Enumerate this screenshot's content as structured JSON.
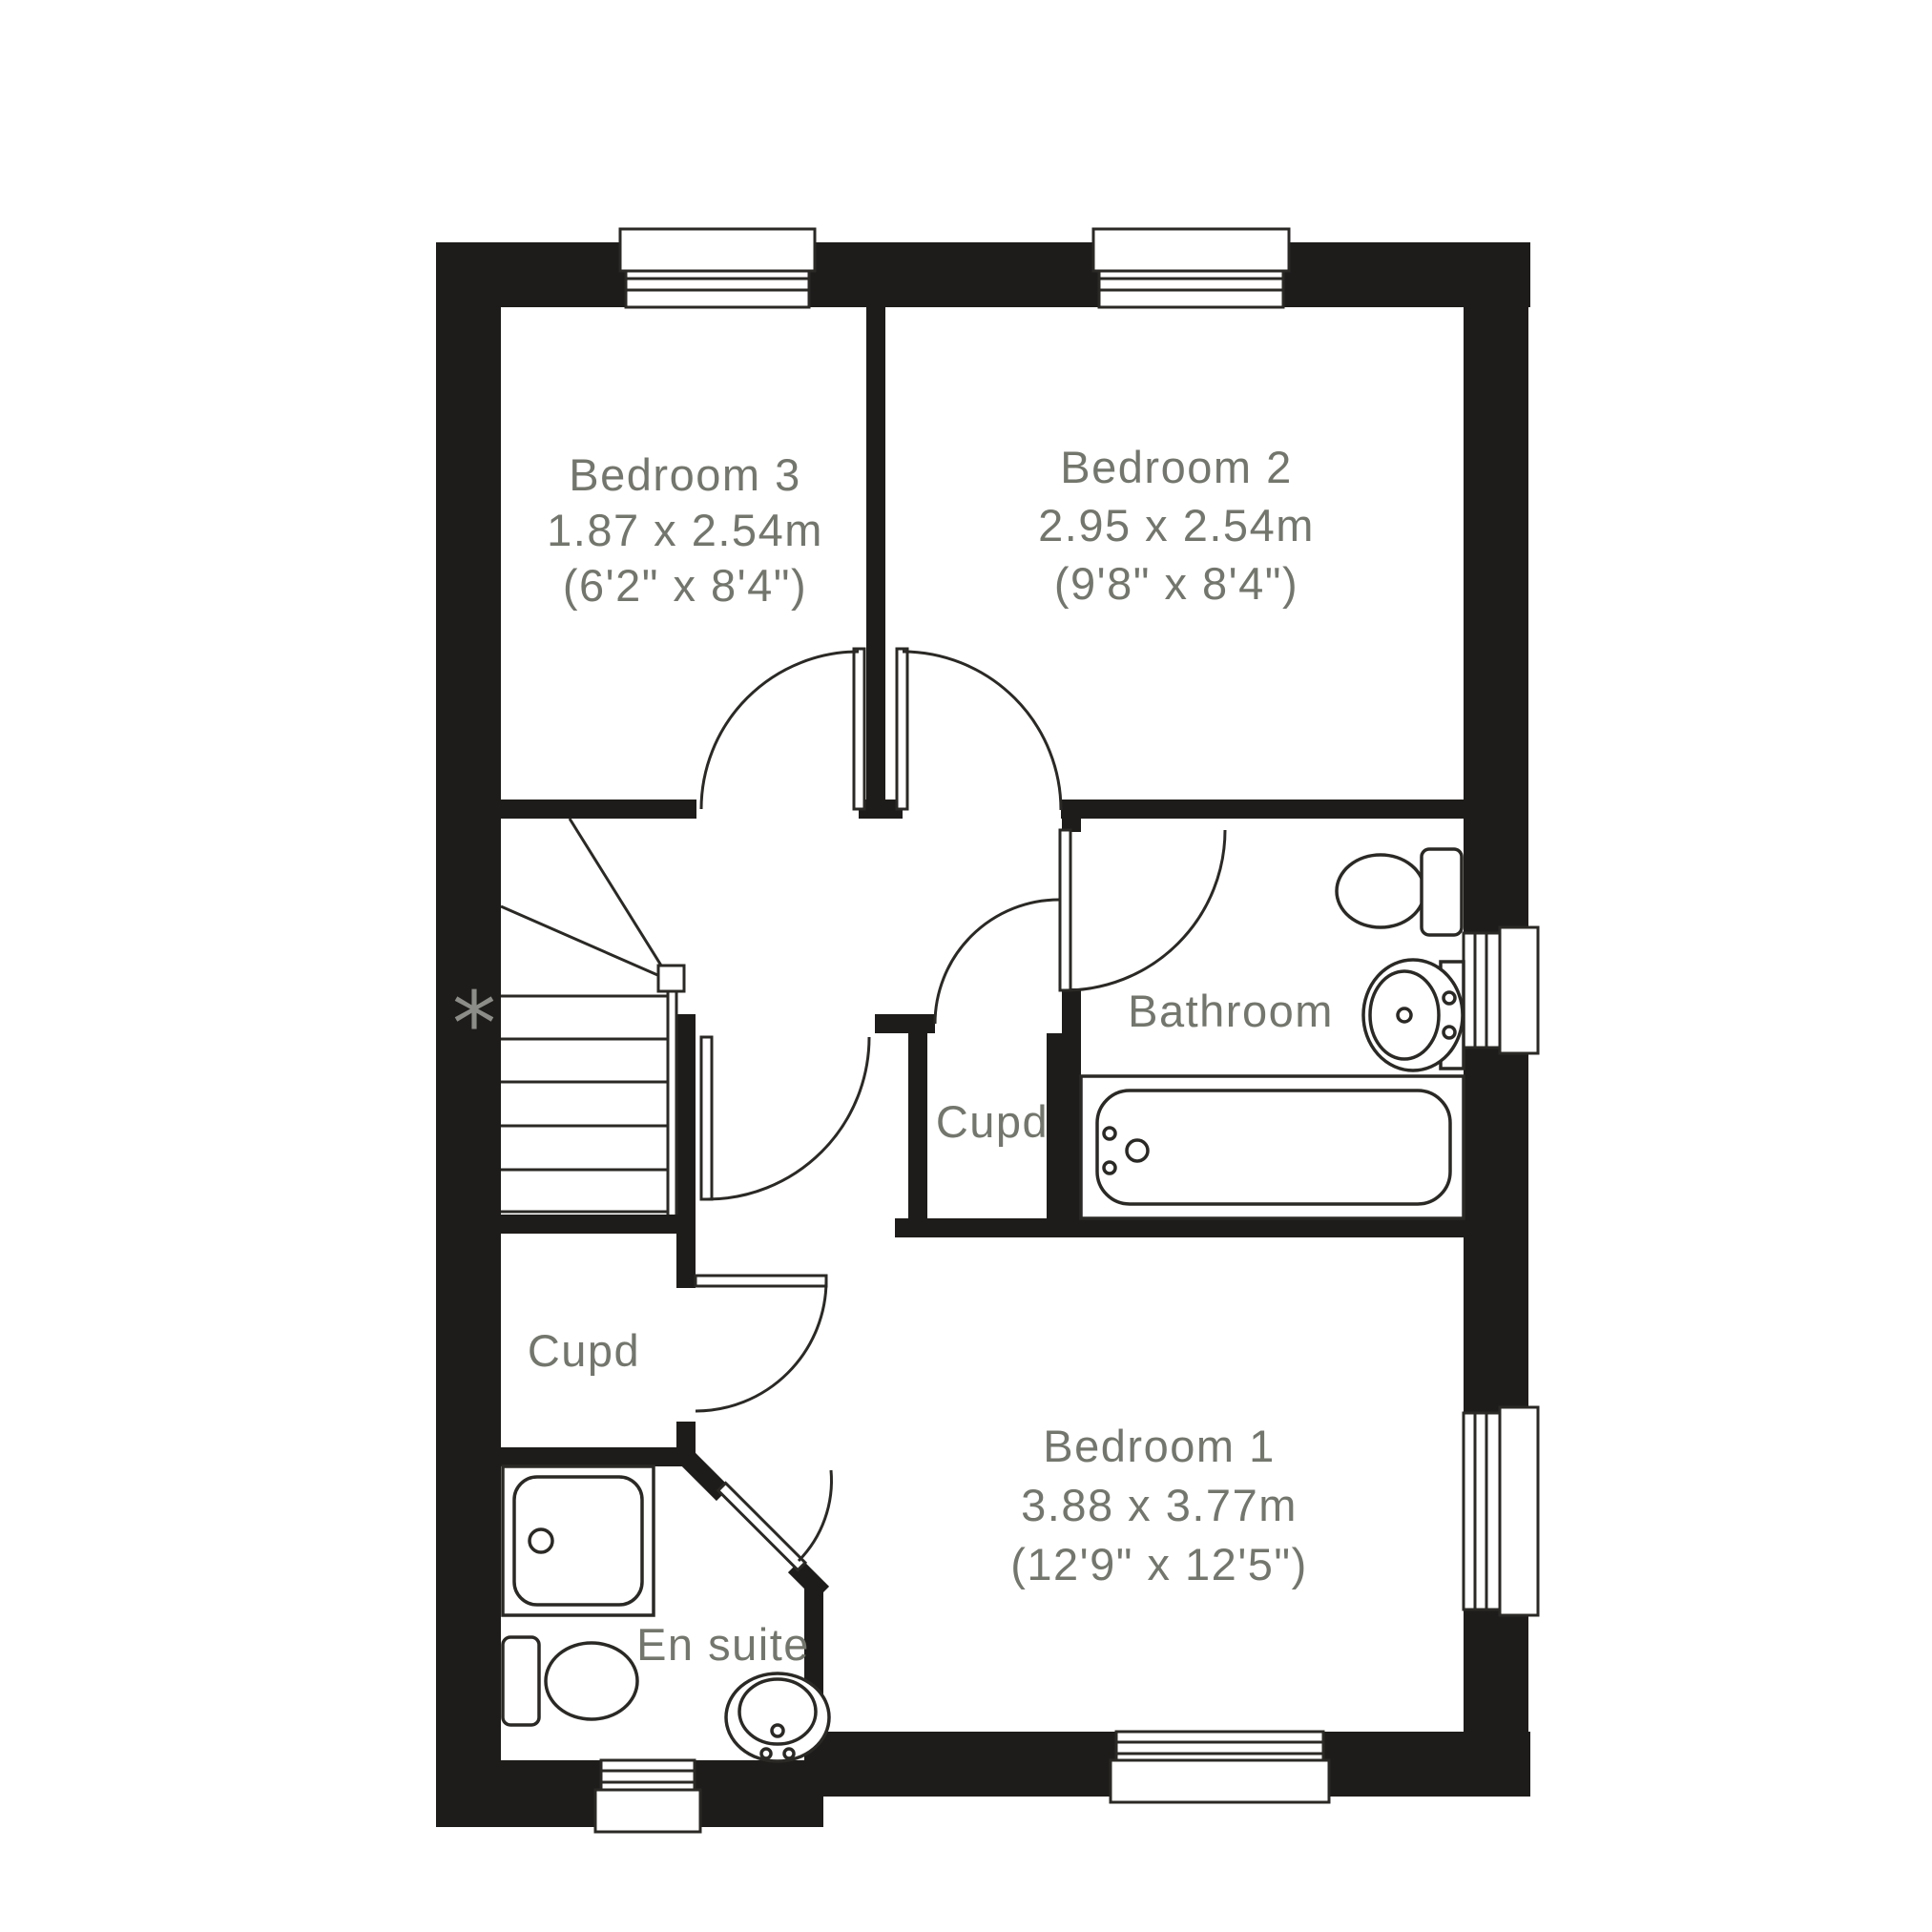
{
  "floorplan": {
    "rooms": {
      "bedroom3": {
        "name": "Bedroom 3",
        "dimensions_metric": "1.87 x 2.54m",
        "dimensions_imperial": "(6'2\" x 8'4\")"
      },
      "bedroom2": {
        "name": "Bedroom 2",
        "dimensions_metric": "2.95 x 2.54m",
        "dimensions_imperial": "(9'8\" x 8'4\")"
      },
      "bedroom1": {
        "name": "Bedroom 1",
        "dimensions_metric": "3.88 x 3.77m",
        "dimensions_imperial": "(12'9\" x 12'5\")"
      },
      "bathroom": {
        "name": "Bathroom"
      },
      "cupboard_upper": {
        "name": "Cupd"
      },
      "cupboard_lower": {
        "name": "Cupd"
      },
      "ensuite": {
        "name": "En suite"
      }
    },
    "annotations": {
      "stairs_marker": "*"
    },
    "colors": {
      "wall": "#1e1c1a",
      "label_text": "#73766c",
      "line": "#2b2925",
      "marker": "#8c8c88",
      "background": "#ffffff"
    }
  }
}
